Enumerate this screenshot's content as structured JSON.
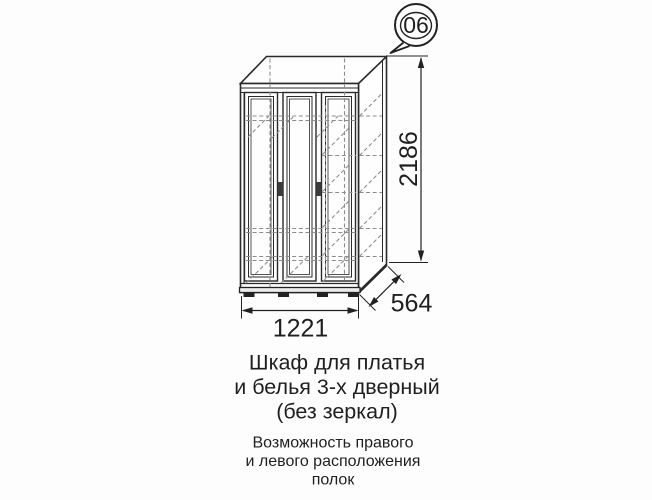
{
  "page": {
    "background_color": "#fdfdfd"
  },
  "badge": {
    "number": "06"
  },
  "drawing": {
    "kind": "furniture technical drawing, 3-door wardrobe, oblique projection",
    "dimensions": {
      "height_mm": "2186",
      "width_mm": "1221",
      "depth_mm": "564"
    },
    "colors": {
      "line": "#2a2a2a",
      "hidden_line": "#8c8c8c",
      "handle": "#3b3b3b"
    }
  },
  "title": {
    "line1": "Шкаф для платья",
    "line2": "и белья 3-х дверный",
    "line3": "(без зеркал)"
  },
  "note": {
    "line1": "Возможность правого",
    "line2": "и левого расположения",
    "line3": "полок"
  }
}
